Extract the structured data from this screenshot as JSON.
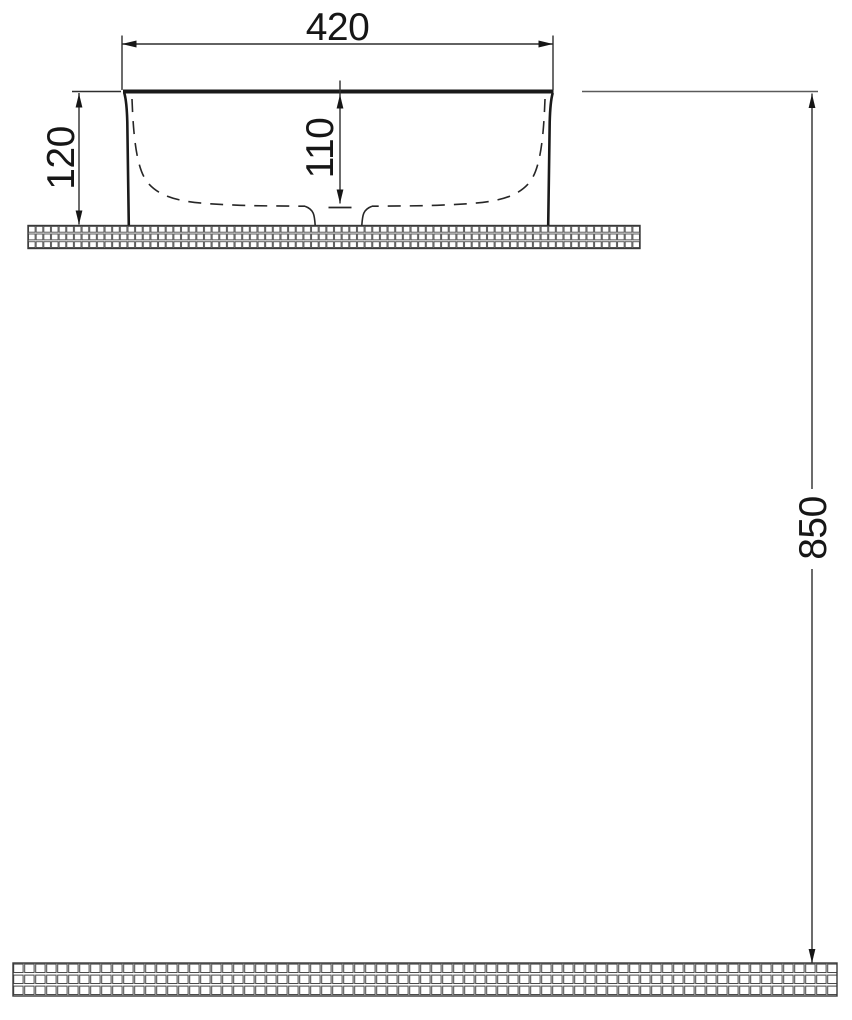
{
  "drawing": {
    "type": "technical-dimension-drawing",
    "subject": "countertop-washbasin-side-elevation",
    "dimensions": {
      "basin_width": {
        "label": "420"
      },
      "basin_height": {
        "label": "120"
      },
      "basin_inner_depth": {
        "label": "110"
      },
      "counter_mount_height": {
        "label": "850"
      }
    },
    "colors": {
      "outline": "#1a1a1a",
      "dimension_line": "#2e2e2e",
      "extension_line": "#5a5a5a",
      "hatch_line": "#4a4a4a",
      "background": "#ffffff"
    }
  }
}
